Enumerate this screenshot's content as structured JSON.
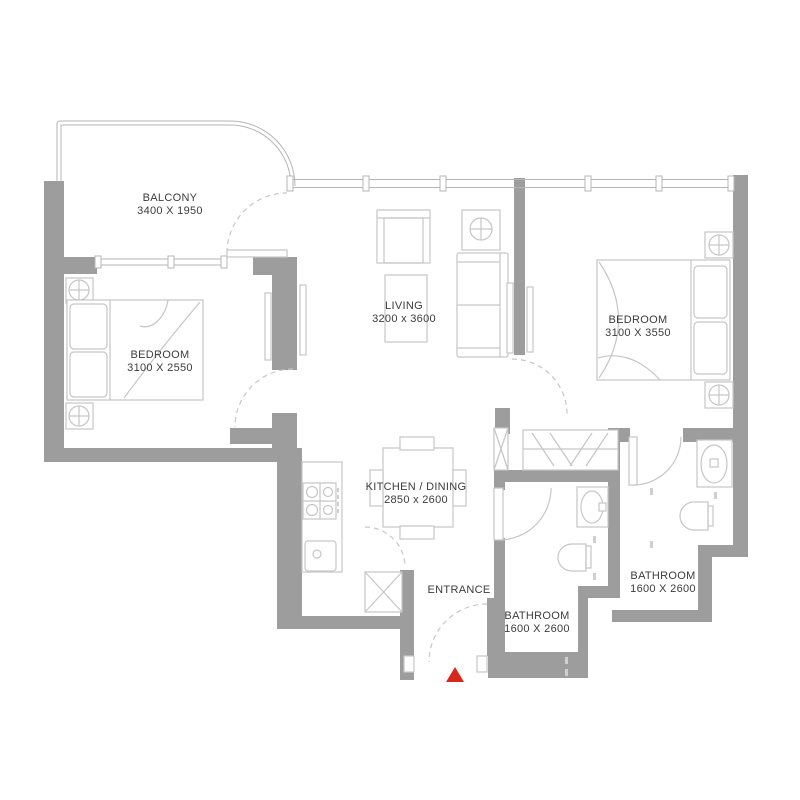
{
  "title": "Apartment floor plan",
  "colors": {
    "background": "#ffffff",
    "wall": "#9d9d9d",
    "line": "#c6c6c6",
    "outline": "#b5b5b5",
    "text": "#3c3c3c",
    "marker": "#d6281e"
  },
  "rooms": [
    {
      "id": "balcony",
      "label": "BALCONY",
      "dims": "3400 X 1950"
    },
    {
      "id": "bedroom1",
      "label": "BEDROOM",
      "dims": "3100 X 2550"
    },
    {
      "id": "living",
      "label": "LIVING",
      "dims": "3200 x 3600"
    },
    {
      "id": "bedroom2",
      "label": "BEDROOM",
      "dims": "3100 X 3550"
    },
    {
      "id": "kitchen",
      "label": "KITCHEN / DINING",
      "dims": "2850 x 2600"
    },
    {
      "id": "entrance",
      "label": "ENTRANCE",
      "dims": ""
    },
    {
      "id": "bathroom1",
      "label": "BATHROOM",
      "dims": "1600 X 2600"
    },
    {
      "id": "bathroom2",
      "label": "BATHROOM",
      "dims": "1600 X 2600"
    }
  ],
  "marker": {
    "name": "entrance-marker",
    "shape": "triangle-up",
    "color": "#d6281e"
  }
}
